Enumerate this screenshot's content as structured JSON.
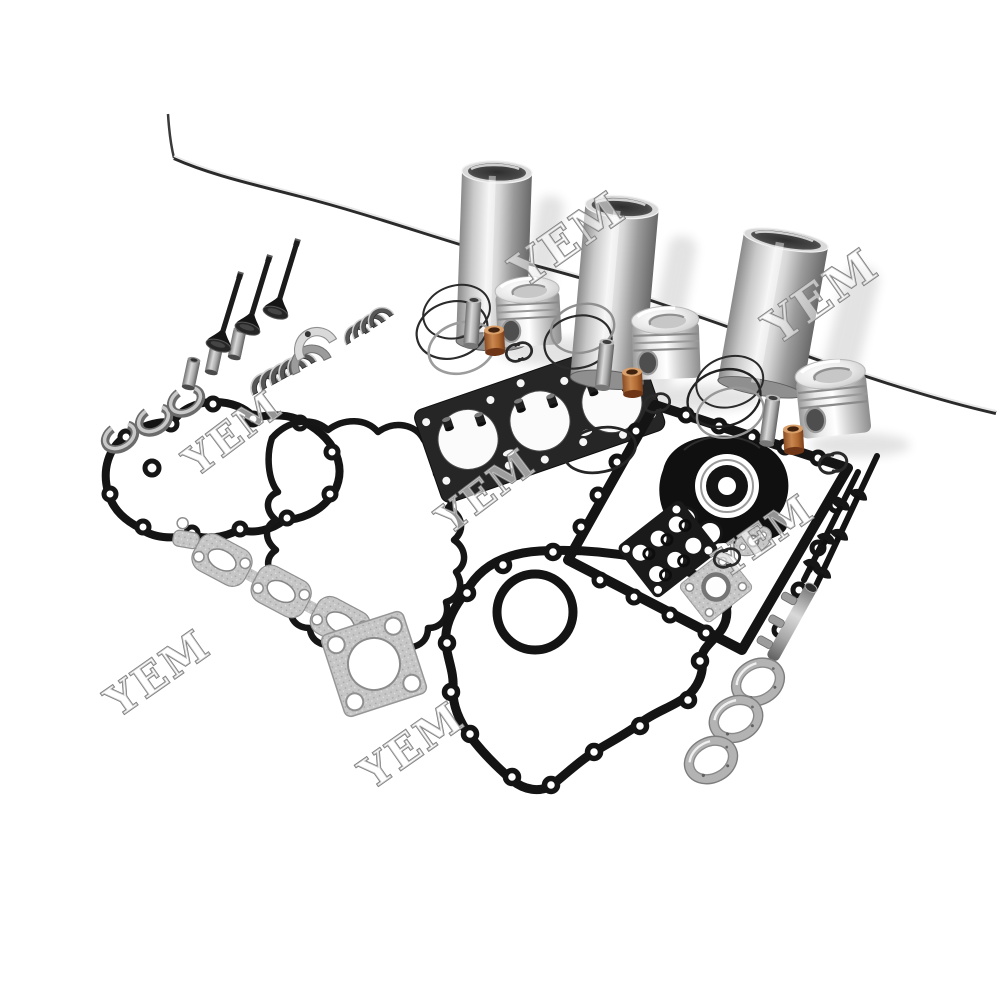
{
  "scene": {
    "alt_text": "Engine overhaul rebuild kit laid out on white: three steel cylinder liners, three pistons with rings and wrist pins, valves, valve guides, bearing shell sets, thrust washers, full gasket set (head gasket, timing cover, gear case, valve cover, exhaust manifold, square exhaust gasket), crankshaft oil seal with pan gasket frame, grommet plate, studs, oil pipe and seat rings",
    "background": "#ffffff"
  },
  "watermark": {
    "text": "YEM",
    "fill": "#ffffff",
    "stroke": "#7c7c7c",
    "instances": [
      {
        "x": 577,
        "y": 252,
        "rot": -35,
        "size": 46
      },
      {
        "x": 830,
        "y": 309,
        "rot": -35,
        "size": 46
      },
      {
        "x": 241,
        "y": 444,
        "rot": -37,
        "size": 40
      },
      {
        "x": 494,
        "y": 502,
        "rot": -37,
        "size": 40
      },
      {
        "x": 166,
        "y": 685,
        "rot": -35,
        "size": 42
      },
      {
        "x": 420,
        "y": 757,
        "rot": -35,
        "size": 42
      },
      {
        "x": 772,
        "y": 547,
        "rot": -35,
        "size": 40
      }
    ]
  },
  "brand_mark": {
    "name": "interlocked-c-rings",
    "color": "#2a2a2a",
    "instances": [
      {
        "x": 519,
        "y": 352,
        "rot": -15,
        "scale": 1.2
      },
      {
        "x": 657,
        "y": 403,
        "rot": -15,
        "scale": 1.2
      },
      {
        "x": 833,
        "y": 463,
        "rot": -15,
        "scale": 1.3
      },
      {
        "x": 727,
        "y": 558,
        "rot": -15,
        "scale": 1.2
      }
    ]
  },
  "palette": {
    "steel_light": "#e8e8e8",
    "steel_mid": "#b5b5b5",
    "steel_dark": "#6e6e6e",
    "gasket_black": "#161616",
    "gasket_gray": "#c6c6c6",
    "copper": "#b5763f",
    "valve_black": "#1a1a1a",
    "background": "#ffffff"
  }
}
